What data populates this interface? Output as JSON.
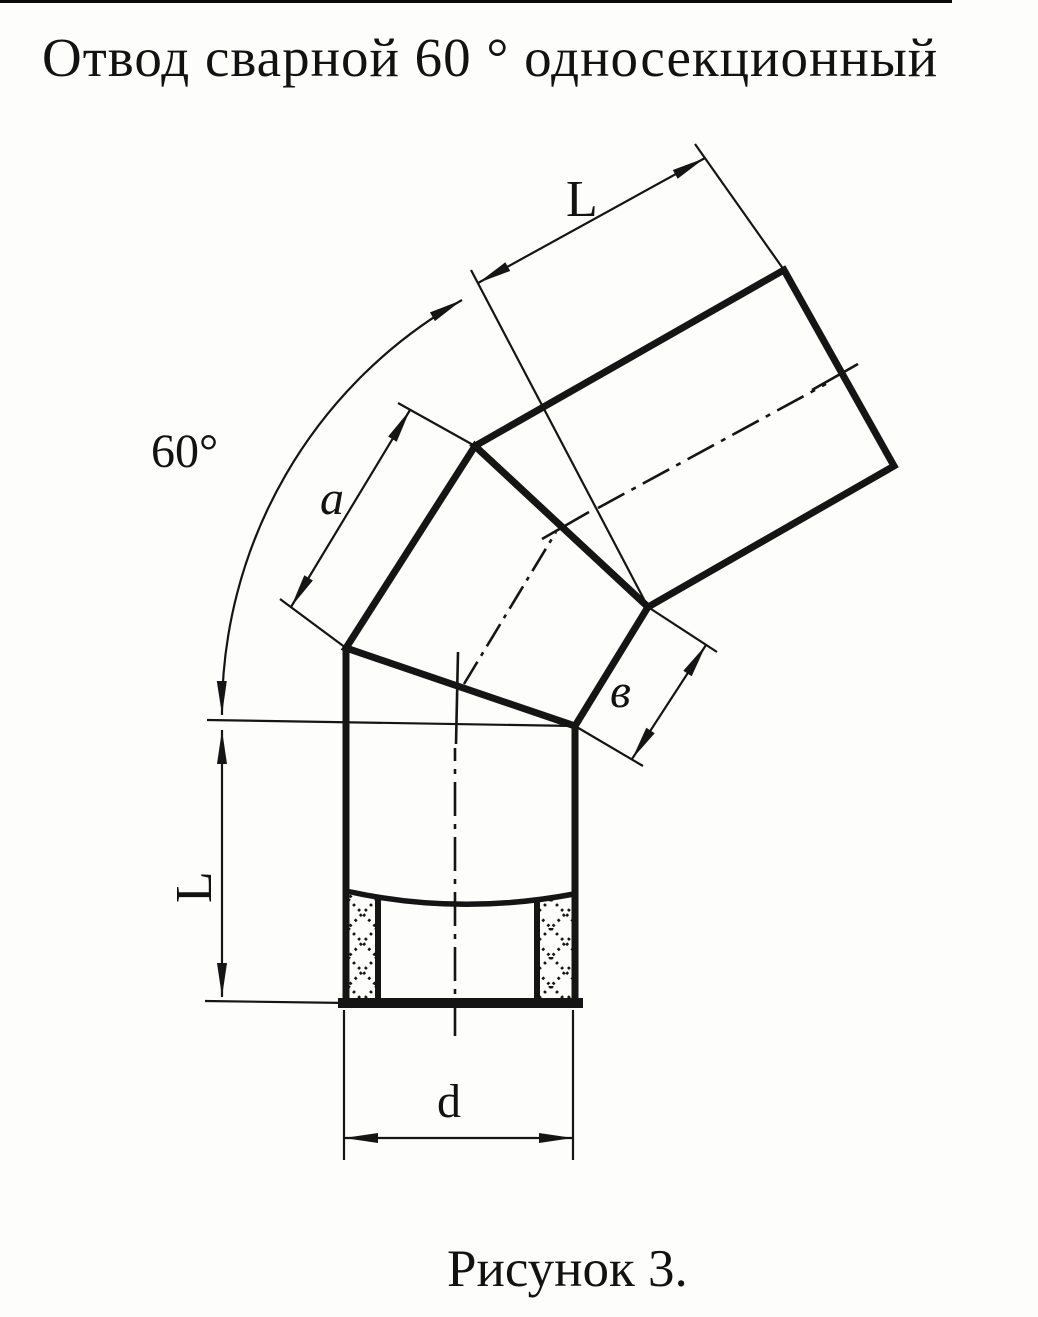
{
  "title": "Отвод сварной 60 ° односекционный",
  "caption": "Рисунок 3.",
  "labels": {
    "upper_length": "L",
    "bend_angle": "60°",
    "section_edge_long": "a",
    "section_edge_short": "в",
    "lower_length": "L",
    "diameter": "d"
  },
  "colors": {
    "ink": "#151515",
    "paper": "#fdfdfb"
  }
}
